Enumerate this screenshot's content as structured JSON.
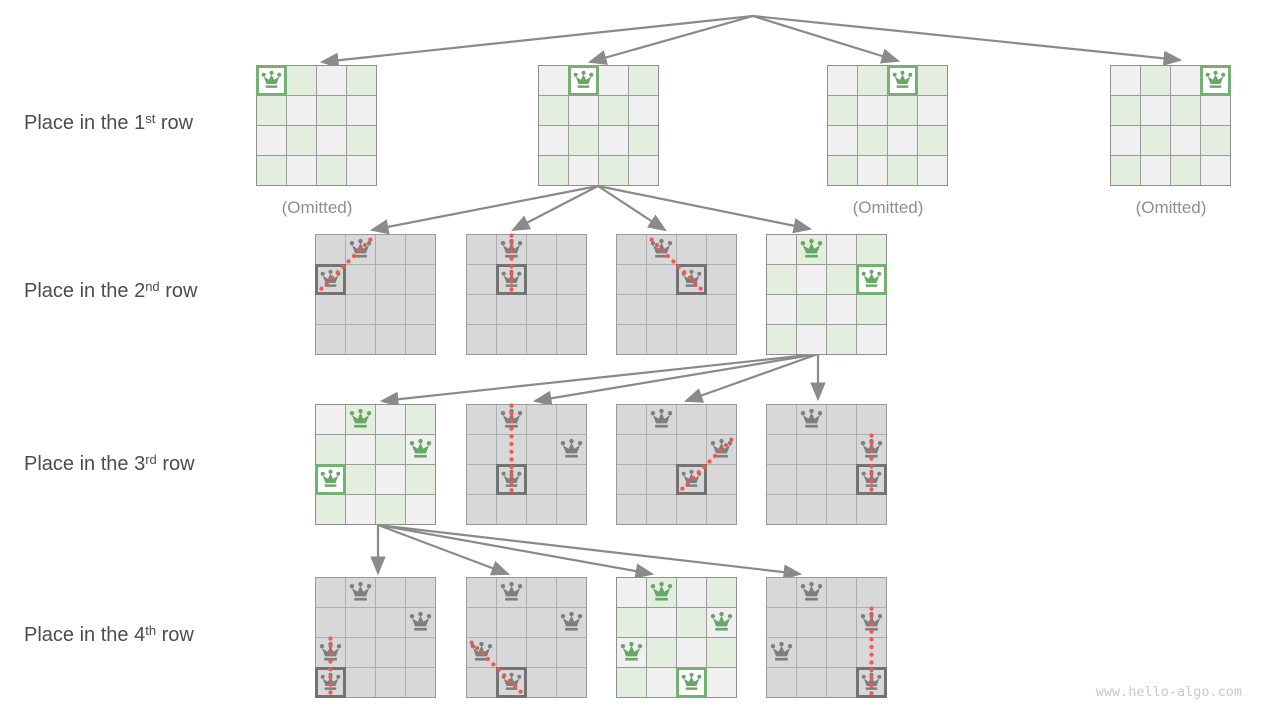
{
  "labels": {
    "rows": [
      {
        "pre": "Place in the 1",
        "sup": "st",
        "post": " row"
      },
      {
        "pre": "Place in the 2",
        "sup": "nd",
        "post": " row"
      },
      {
        "pre": "Place in the 3",
        "sup": "rd",
        "post": " row"
      },
      {
        "pre": "Place in the 4",
        "sup": "th",
        "post": " row"
      }
    ],
    "omitted": "(Omitted)",
    "watermark": "www.hello-algo.com"
  },
  "icons": {
    "queen": "chess-queen-icon",
    "arrow": "tree-edge-arrow"
  },
  "colors": {
    "label_text": "#4d4d4d",
    "omitted_text": "#8f8f8f",
    "watermark_text": "#c9c9c9",
    "arrow": "#8a8a8a",
    "valid_cell_green": "#e4eedf",
    "valid_cell_gray": "#f0f0f0",
    "valid_gridline": "#9a9a9a",
    "invalid_cell": "#d8d8d8",
    "invalid_gridline": "#aeaeae",
    "queen_green": "#68a768",
    "queen_gray": "#7e7e7e",
    "new_border_green": "#74b274",
    "attempt_border_gray": "#737373",
    "new_cell_bg": "#ffffff",
    "conflict_red": "#f4574f"
  },
  "diagram": {
    "board_cells": 4,
    "cell_px": 30,
    "row_label_centers_y": [
      125,
      293,
      466,
      637
    ],
    "omitted_positions": [
      {
        "x": 256,
        "y": 198
      },
      {
        "x": 827,
        "y": 198
      },
      {
        "x": 1110,
        "y": 198
      }
    ],
    "boards": [
      {
        "id": "level1-board1",
        "x": 256,
        "y": 65,
        "variant": "valid",
        "queens": [
          {
            "r": 0,
            "c": 0,
            "state": "new"
          }
        ]
      },
      {
        "id": "level1-board2",
        "x": 538,
        "y": 65,
        "variant": "valid",
        "queens": [
          {
            "r": 0,
            "c": 1,
            "state": "new"
          }
        ]
      },
      {
        "id": "level1-board3",
        "x": 827,
        "y": 65,
        "variant": "valid",
        "queens": [
          {
            "r": 0,
            "c": 2,
            "state": "new"
          }
        ]
      },
      {
        "id": "level1-board4",
        "x": 1110,
        "y": 65,
        "variant": "valid",
        "queens": [
          {
            "r": 0,
            "c": 3,
            "state": "new"
          }
        ]
      },
      {
        "id": "level2-board1",
        "x": 315,
        "y": 234,
        "variant": "invalid",
        "queens": [
          {
            "r": 0,
            "c": 1,
            "state": "placed"
          },
          {
            "r": 1,
            "c": 0,
            "state": "attempt"
          }
        ],
        "conflict": {
          "r1": 0,
          "c1": 1,
          "r2": 1,
          "c2": 0
        }
      },
      {
        "id": "level2-board2",
        "x": 466,
        "y": 234,
        "variant": "invalid",
        "queens": [
          {
            "r": 0,
            "c": 1,
            "state": "placed"
          },
          {
            "r": 1,
            "c": 1,
            "state": "attempt"
          }
        ],
        "conflict": {
          "r1": 0,
          "c1": 1,
          "r2": 1,
          "c2": 1
        }
      },
      {
        "id": "level2-board3",
        "x": 616,
        "y": 234,
        "variant": "invalid",
        "queens": [
          {
            "r": 0,
            "c": 1,
            "state": "placed"
          },
          {
            "r": 1,
            "c": 2,
            "state": "attempt"
          }
        ],
        "conflict": {
          "r1": 0,
          "c1": 1,
          "r2": 1,
          "c2": 2
        }
      },
      {
        "id": "level2-board4",
        "x": 766,
        "y": 234,
        "variant": "valid",
        "queens": [
          {
            "r": 0,
            "c": 1,
            "state": "placed"
          },
          {
            "r": 1,
            "c": 3,
            "state": "new"
          }
        ]
      },
      {
        "id": "level3-board1",
        "x": 315,
        "y": 404,
        "variant": "valid",
        "queens": [
          {
            "r": 0,
            "c": 1,
            "state": "placed"
          },
          {
            "r": 1,
            "c": 3,
            "state": "placed"
          },
          {
            "r": 2,
            "c": 0,
            "state": "new"
          }
        ]
      },
      {
        "id": "level3-board2",
        "x": 466,
        "y": 404,
        "variant": "invalid",
        "queens": [
          {
            "r": 0,
            "c": 1,
            "state": "placed"
          },
          {
            "r": 1,
            "c": 3,
            "state": "placed"
          },
          {
            "r": 2,
            "c": 1,
            "state": "attempt"
          }
        ],
        "conflict": {
          "r1": 0,
          "c1": 1,
          "r2": 2,
          "c2": 1
        }
      },
      {
        "id": "level3-board3",
        "x": 616,
        "y": 404,
        "variant": "invalid",
        "queens": [
          {
            "r": 0,
            "c": 1,
            "state": "placed"
          },
          {
            "r": 1,
            "c": 3,
            "state": "placed"
          },
          {
            "r": 2,
            "c": 2,
            "state": "attempt"
          }
        ],
        "conflict": {
          "r1": 1,
          "c1": 3,
          "r2": 2,
          "c2": 2
        }
      },
      {
        "id": "level3-board4",
        "x": 766,
        "y": 404,
        "variant": "invalid",
        "queens": [
          {
            "r": 0,
            "c": 1,
            "state": "placed"
          },
          {
            "r": 1,
            "c": 3,
            "state": "placed"
          },
          {
            "r": 2,
            "c": 3,
            "state": "attempt"
          }
        ],
        "conflict": {
          "r1": 1,
          "c1": 3,
          "r2": 2,
          "c2": 3
        }
      },
      {
        "id": "level4-board1",
        "x": 315,
        "y": 577,
        "variant": "invalid",
        "queens": [
          {
            "r": 0,
            "c": 1,
            "state": "placed"
          },
          {
            "r": 1,
            "c": 3,
            "state": "placed"
          },
          {
            "r": 2,
            "c": 0,
            "state": "placed"
          },
          {
            "r": 3,
            "c": 0,
            "state": "attempt"
          }
        ],
        "conflict": {
          "r1": 2,
          "c1": 0,
          "r2": 3,
          "c2": 0
        }
      },
      {
        "id": "level4-board2",
        "x": 466,
        "y": 577,
        "variant": "invalid",
        "queens": [
          {
            "r": 0,
            "c": 1,
            "state": "placed"
          },
          {
            "r": 1,
            "c": 3,
            "state": "placed"
          },
          {
            "r": 2,
            "c": 0,
            "state": "placed"
          },
          {
            "r": 3,
            "c": 1,
            "state": "attempt"
          }
        ],
        "conflict": {
          "r1": 2,
          "c1": 0,
          "r2": 3,
          "c2": 1
        }
      },
      {
        "id": "level4-board3",
        "x": 616,
        "y": 577,
        "variant": "valid",
        "queens": [
          {
            "r": 0,
            "c": 1,
            "state": "placed"
          },
          {
            "r": 1,
            "c": 3,
            "state": "placed"
          },
          {
            "r": 2,
            "c": 0,
            "state": "placed"
          },
          {
            "r": 3,
            "c": 2,
            "state": "new"
          }
        ]
      },
      {
        "id": "level4-board4",
        "x": 766,
        "y": 577,
        "variant": "invalid",
        "queens": [
          {
            "r": 0,
            "c": 1,
            "state": "placed"
          },
          {
            "r": 1,
            "c": 3,
            "state": "placed"
          },
          {
            "r": 2,
            "c": 0,
            "state": "placed"
          },
          {
            "r": 3,
            "c": 3,
            "state": "attempt"
          }
        ],
        "conflict": {
          "r1": 1,
          "c1": 3,
          "r2": 3,
          "c2": 3
        }
      }
    ],
    "arrows": [
      {
        "x1": 753,
        "y1": 16,
        "x2": 322,
        "y2": 62
      },
      {
        "x1": 753,
        "y1": 16,
        "x2": 590,
        "y2": 62
      },
      {
        "x1": 753,
        "y1": 16,
        "x2": 898,
        "y2": 61
      },
      {
        "x1": 753,
        "y1": 16,
        "x2": 1180,
        "y2": 60
      },
      {
        "x1": 598,
        "y1": 186,
        "x2": 372,
        "y2": 230
      },
      {
        "x1": 598,
        "y1": 186,
        "x2": 513,
        "y2": 230
      },
      {
        "x1": 598,
        "y1": 186,
        "x2": 665,
        "y2": 230
      },
      {
        "x1": 598,
        "y1": 186,
        "x2": 810,
        "y2": 229
      },
      {
        "x1": 818,
        "y1": 354,
        "x2": 382,
        "y2": 401
      },
      {
        "x1": 818,
        "y1": 354,
        "x2": 535,
        "y2": 401
      },
      {
        "x1": 818,
        "y1": 354,
        "x2": 686,
        "y2": 401
      },
      {
        "x1": 818,
        "y1": 354,
        "x2": 818,
        "y2": 399
      },
      {
        "x1": 378,
        "y1": 525,
        "x2": 378,
        "y2": 573
      },
      {
        "x1": 378,
        "y1": 525,
        "x2": 508,
        "y2": 574
      },
      {
        "x1": 378,
        "y1": 525,
        "x2": 652,
        "y2": 574
      },
      {
        "x1": 378,
        "y1": 525,
        "x2": 800,
        "y2": 574
      }
    ]
  }
}
